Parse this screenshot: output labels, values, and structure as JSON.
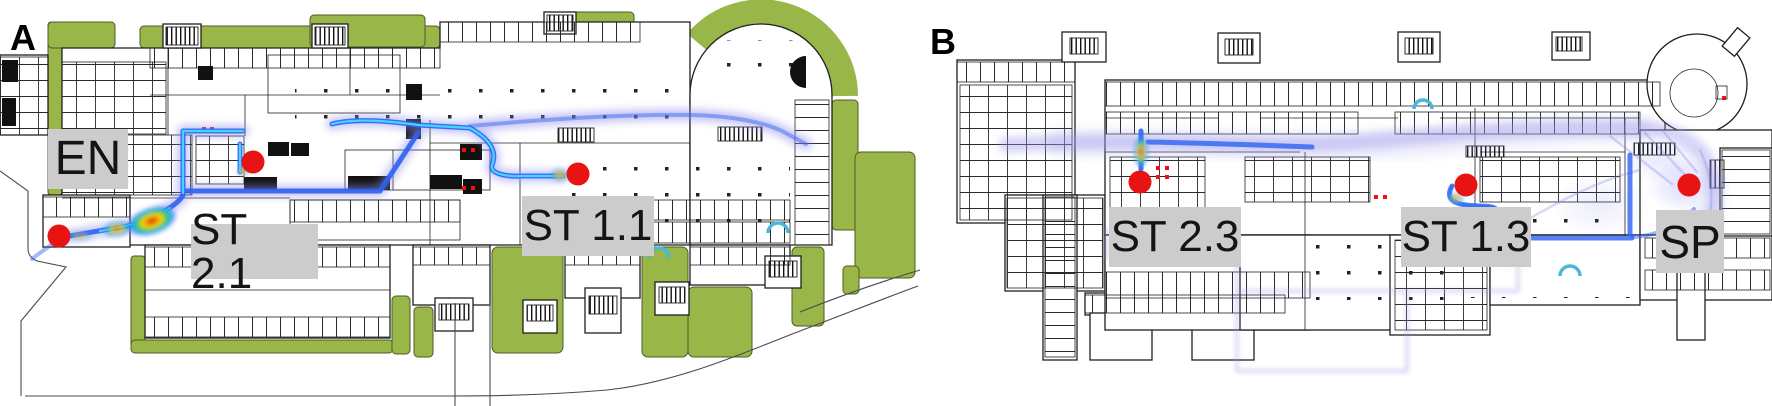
{
  "figure": {
    "panels": [
      {
        "letter": "A",
        "stations": [
          {
            "label": "EN"
          },
          {
            "label": "ST 2.1"
          },
          {
            "label": "ST 1.1"
          }
        ]
      },
      {
        "letter": "B",
        "stations": [
          {
            "label": "ST 2.3"
          },
          {
            "label": "ST 1.3"
          },
          {
            "label": "SP"
          }
        ]
      }
    ],
    "colors": {
      "landscape_green": "#99b649",
      "station_label_bg": "#cccccc",
      "station_label_text": "#141414",
      "marker_red": "#e81313",
      "wall": "#1f1f1f",
      "trajectory_blue": "#2e62f2",
      "trajectory_cyan_core": "#45dcff",
      "trajectory_glow": "#8d8ded",
      "hotspot_jet_peak": "#c81000"
    }
  }
}
